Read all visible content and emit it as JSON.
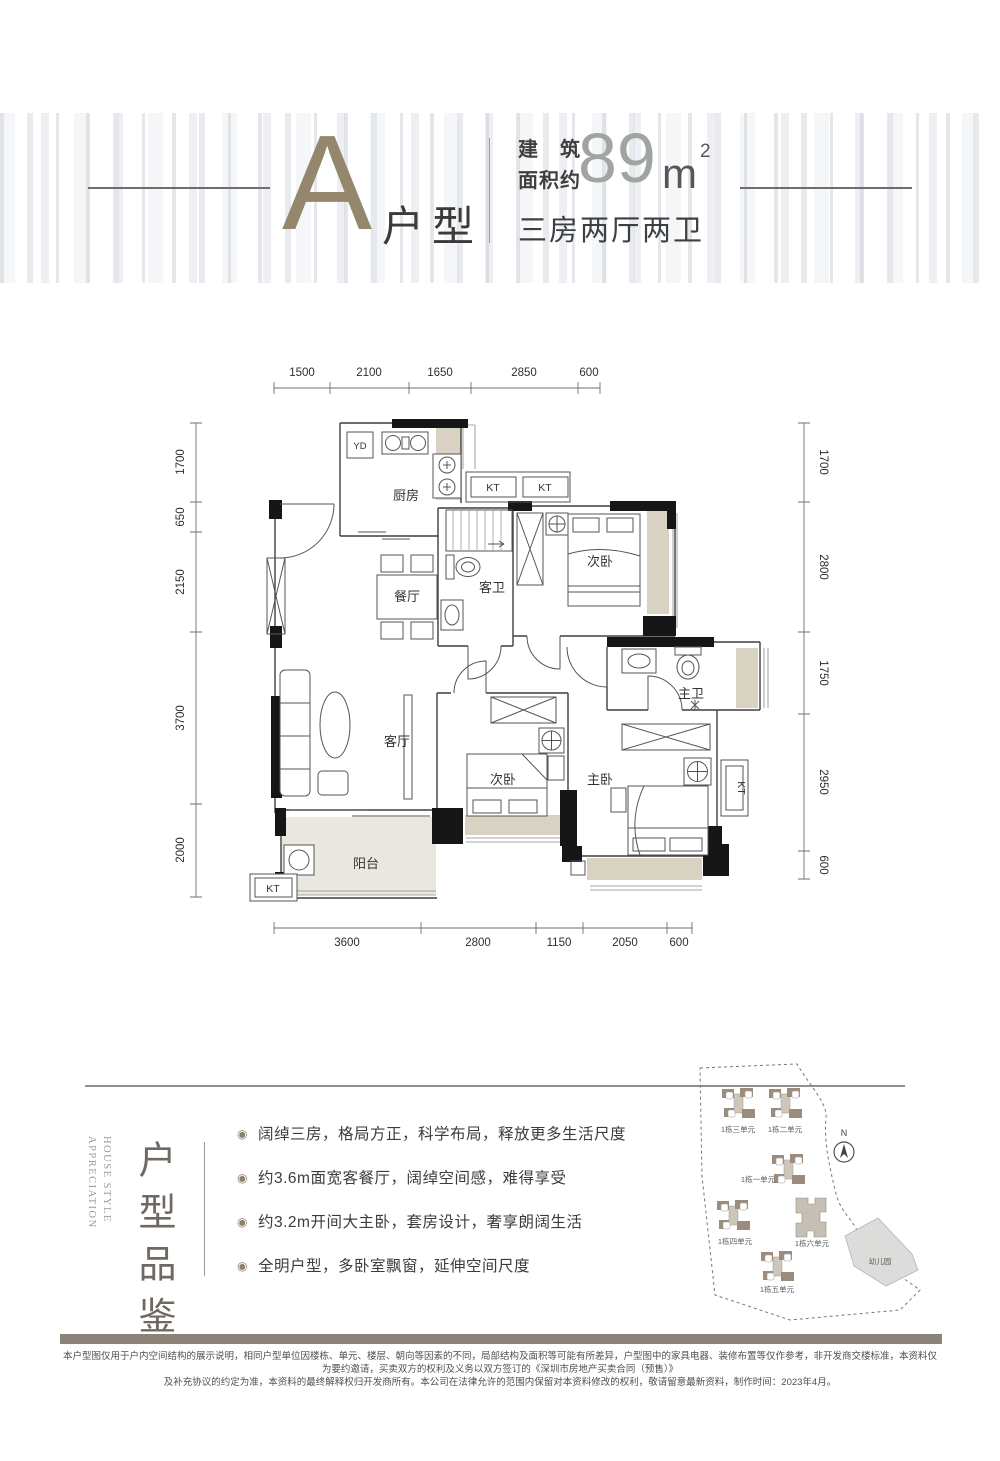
{
  "header": {
    "unit": "A",
    "unit_suffix": "户型",
    "area_label_l1": "建筑",
    "area_label_l2": "面积约",
    "area_value": "89",
    "area_unit": "m",
    "area_exp": "2",
    "subtitle": "三房两厅两卫"
  },
  "floorplan": {
    "dims": {
      "top": [
        "1500",
        "2100",
        "1650",
        "2850",
        "600"
      ],
      "left": [
        "1700",
        "650",
        "2150",
        "3700",
        "2000"
      ],
      "right": [
        "1700",
        "2800",
        "1750",
        "2950",
        "600"
      ],
      "bottom": [
        "3600",
        "2800",
        "1150",
        "2050",
        "600"
      ]
    },
    "rooms": {
      "kitchen": "厨房",
      "dining": "餐厅",
      "guest_bath": "客卫",
      "bedroom_top": "次卧",
      "living": "客厅",
      "bedroom_mid": "次卧",
      "master": "主卧",
      "master_bath": "主卫",
      "balcony": "阳台",
      "yd": "YD",
      "kt": "KT"
    }
  },
  "features": {
    "title_cn": "户型品鉴",
    "title_en_1": "HOUSE STYLE",
    "title_en_2": "APPRECIATION",
    "bullet_icon": "◉",
    "bullets": [
      "阔绰三房，格局方正，科学布局，释放更多生活尺度",
      "约3.6m面宽客餐厅，阔绰空间感，难得享受",
      "约3.2m开间大主卧，套房设计，奢享朗阔生活",
      "全明户型，多卧室飘窗，延伸空间尺度"
    ]
  },
  "sitemap": {
    "compass": "N",
    "kindergarten": "幼儿园",
    "units": [
      {
        "label": "1栋三单元",
        "x": 56,
        "y": 48,
        "lx": 56,
        "ly": 76
      },
      {
        "label": "1栋二单元",
        "x": 103,
        "y": 48,
        "lx": 103,
        "ly": 76
      },
      {
        "label": "1栋一单元",
        "x": 106,
        "y": 114,
        "lx": 76,
        "ly": 126
      },
      {
        "label": "1栋四单元",
        "x": 51,
        "y": 160,
        "lx": 53,
        "ly": 188
      },
      {
        "label": "1栋六单元",
        "x": 129,
        "y": 162,
        "lx": 130,
        "ly": 190,
        "big": true
      },
      {
        "label": "1栋五单元",
        "x": 95,
        "y": 211,
        "lx": 95,
        "ly": 236
      }
    ]
  },
  "disclaimer": {
    "line1": "本户型图仅用于户内空间结构的展示说明，相同户型单位因楼栋、单元、楼层、朝向等因素的不同，局部结构及面积等可能有所差异，户型图中的家具电器、装修布置等仅作参考，非开发商交楼标准，本资料仅为要约邀请，买卖双方的权利及义务以双方签订的《深圳市房地产买卖合同（预售）》",
    "line2": "及补充协议的约定为准，本资料的最终解释权归开发商所有。本公司在法律允许的范围内保留对本资料修改的权利，敬请留意最新资料，制作时间：2023年4月。"
  }
}
